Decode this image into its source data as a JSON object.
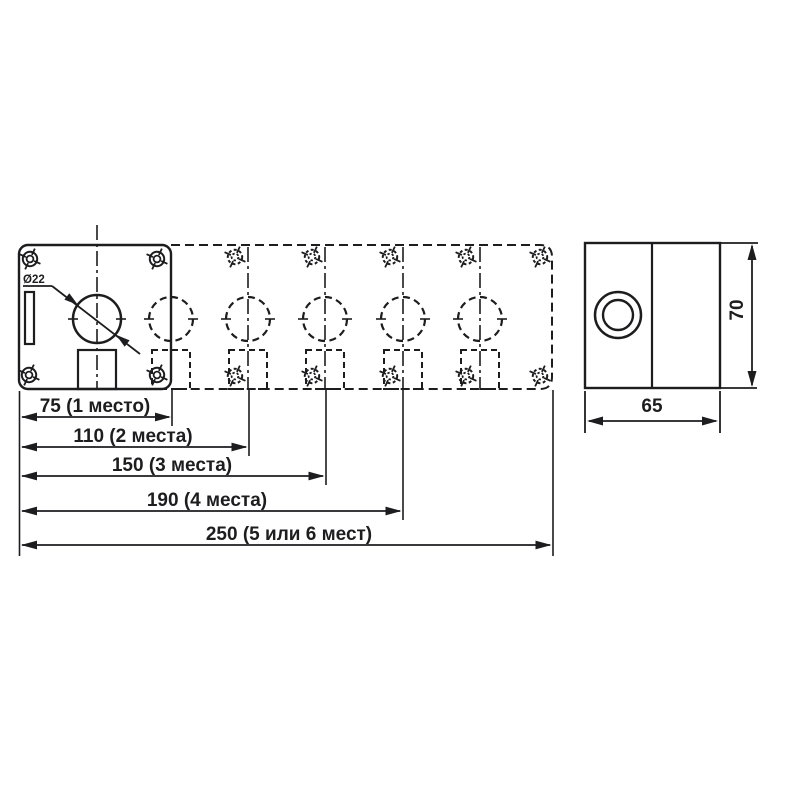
{
  "drawing": {
    "type": "technical dimensional drawing of push-button enclosure",
    "colors": {
      "line": "#1d1d1f",
      "background": "#ffffff"
    },
    "front": {
      "dia_label": "Ø22",
      "dims": [
        {
          "value": 75,
          "label": "75 (1 место)"
        },
        {
          "value": 110,
          "label": "110 (2 места)"
        },
        {
          "value": 150,
          "label": "150 (3 места)"
        },
        {
          "value": 190,
          "label": "190 (4 места)"
        },
        {
          "value": 250,
          "label": "250 (5 или 6 мест)"
        }
      ]
    },
    "side": {
      "width_label": "65",
      "height_label": "70"
    }
  }
}
